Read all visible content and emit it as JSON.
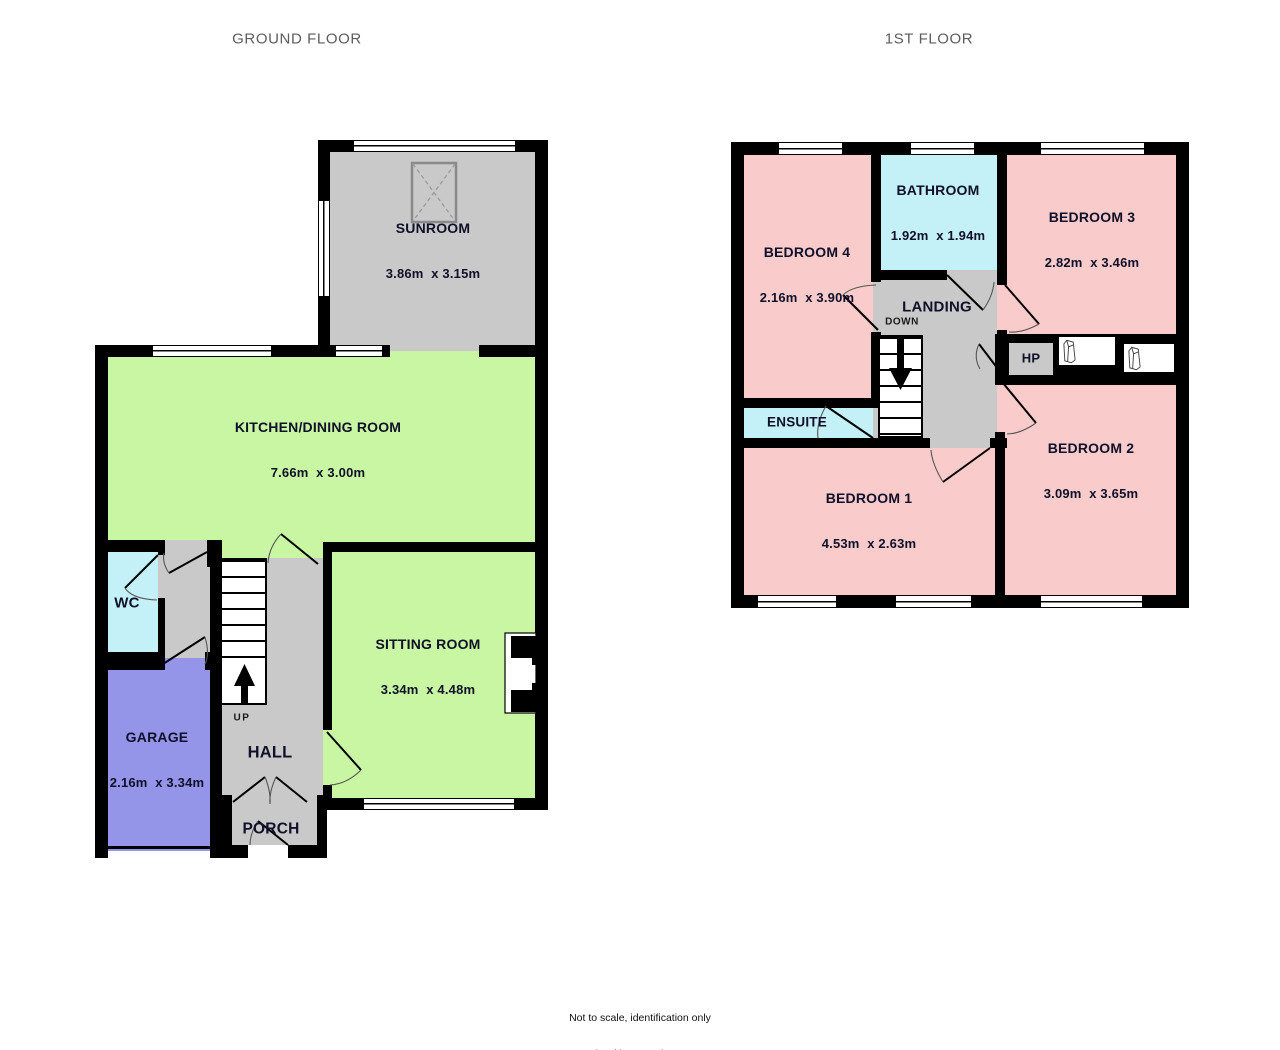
{
  "titles": {
    "ground": "GROUND FLOOR",
    "first": "1ST FLOOR"
  },
  "footer": {
    "line1": "Not to scale, identification only",
    "line2": "Made with Metropix ©2025"
  },
  "colors": {
    "wall": "#000000",
    "green": "#c9f6a2",
    "pink": "#f9cbca",
    "cyan": "#c4f0f8",
    "gray": "#c9c9c9",
    "purple": "#9494e8",
    "window": "#ffffff",
    "title_text": "#5d5d5d",
    "label_text": "#10102a"
  },
  "ground": {
    "stair_label": "UP",
    "rooms": [
      {
        "name": "SUNROOM",
        "dims": "3.86m  x 3.15m"
      },
      {
        "name": "KITCHEN/DINING ROOM",
        "dims": "7.66m  x 3.00m"
      },
      {
        "name": "WC",
        "dims": ""
      },
      {
        "name": "GARAGE",
        "dims": "2.16m  x 3.34m"
      },
      {
        "name": "HALL",
        "dims": ""
      },
      {
        "name": "PORCH",
        "dims": ""
      },
      {
        "name": "SITTING ROOM",
        "dims": "3.34m  x 4.48m"
      }
    ]
  },
  "first": {
    "stair_label": "DOWN",
    "rooms": [
      {
        "name": "BEDROOM 4",
        "dims": "2.16m  x 3.90m"
      },
      {
        "name": "BATHROOM",
        "dims": "1.92m  x 1.94m"
      },
      {
        "name": "BEDROOM 3",
        "dims": "2.82m  x 3.46m"
      },
      {
        "name": "LANDING",
        "dims": ""
      },
      {
        "name": "ENSUITE",
        "dims": ""
      },
      {
        "name": "BEDROOM 1",
        "dims": "4.53m  x 2.63m"
      },
      {
        "name": "BEDROOM 2",
        "dims": "3.09m  x 3.65m"
      },
      {
        "name": "HP",
        "dims": ""
      }
    ]
  }
}
